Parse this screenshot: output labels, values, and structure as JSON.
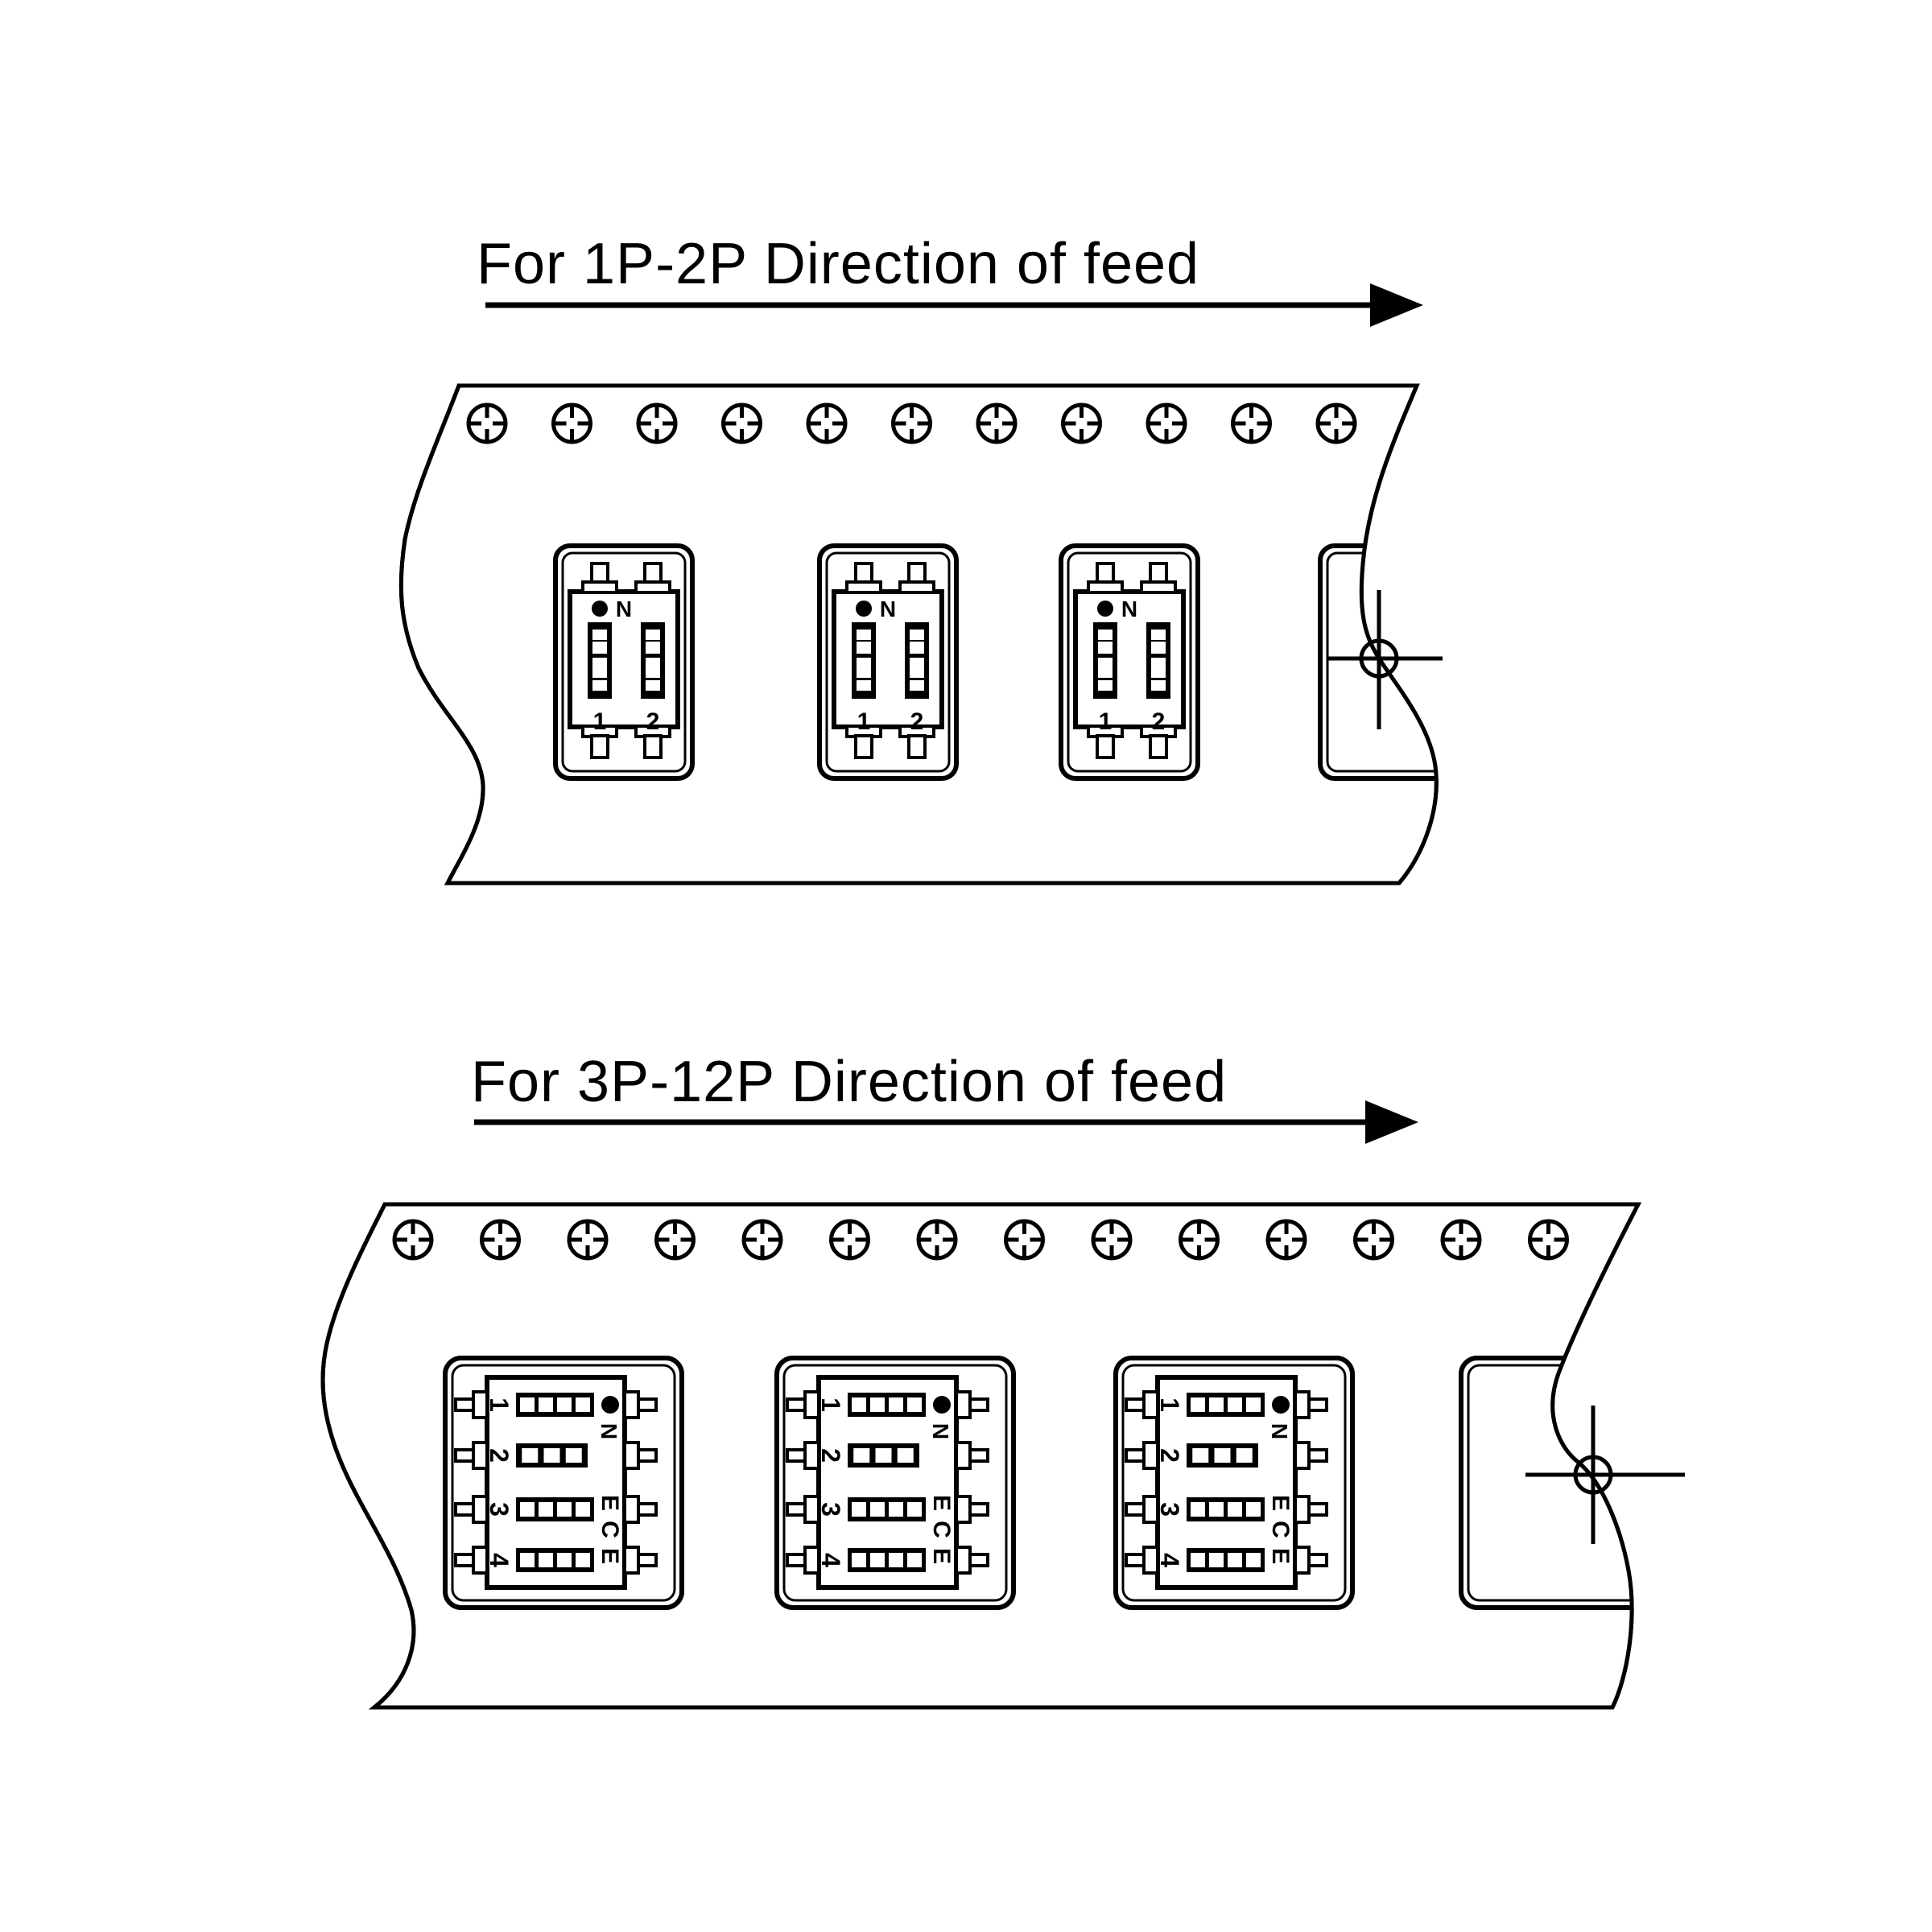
{
  "colors": {
    "background": "#ffffff",
    "line": "#000000"
  },
  "sections": [
    {
      "id": "feed-1p-2p",
      "title": "For 1P-2P Direction of feed",
      "feed_direction": "right",
      "tape": {
        "sprocket_hole_count": 11,
        "component_count": 3,
        "has_partial_empty_pocket": true,
        "has_registration_target": true
      },
      "switch": {
        "orientation": "upright",
        "position_labels": [
          "1",
          "2"
        ],
        "on_index_dot": true,
        "on_label": "N",
        "cells_per_channel": [
          4,
          4
        ]
      }
    },
    {
      "id": "feed-3p-12p",
      "title": "For 3P-12P Direction of feed",
      "feed_direction": "right",
      "tape": {
        "sprocket_hole_count": 14,
        "component_count": 3,
        "has_partial_empty_pocket": true,
        "has_registration_target": true
      },
      "switch": {
        "orientation": "rotated-90-cw",
        "position_labels": [
          "1",
          "2",
          "3",
          "4"
        ],
        "on_index_dot": true,
        "on_label": "N",
        "brand_letters": [
          "E",
          "C",
          "E"
        ],
        "cells_per_channel": [
          4,
          3,
          4,
          4
        ]
      }
    }
  ]
}
